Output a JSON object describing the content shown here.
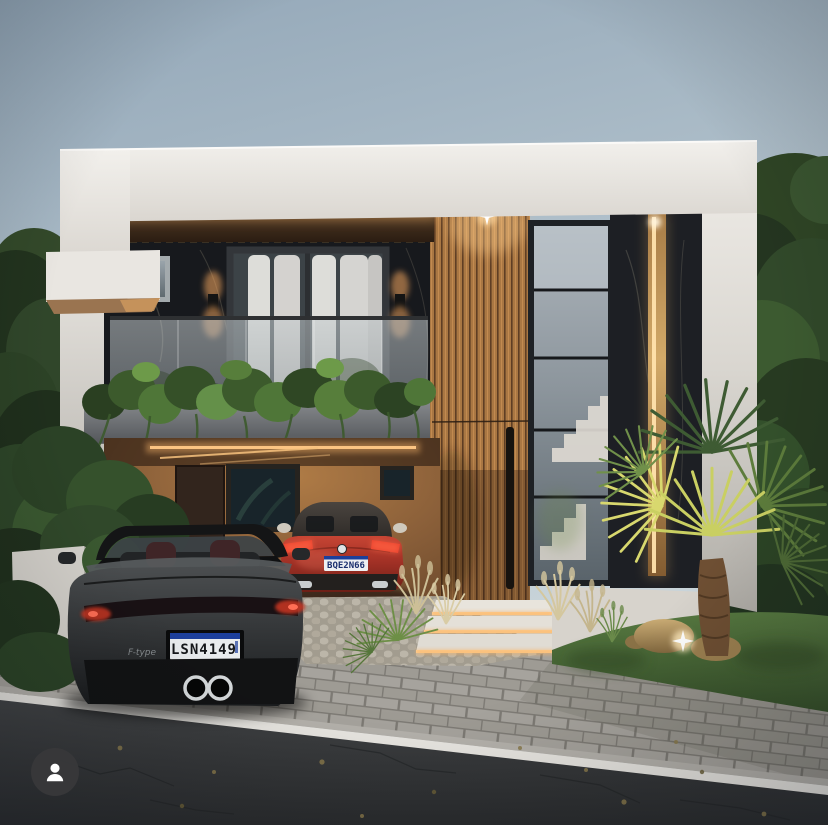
{
  "scene": {
    "black_car": {
      "plate_text": "LSN4149",
      "badge_text": "F-type"
    },
    "red_car": {
      "plate_text": "BQE2N66"
    }
  },
  "ui": {
    "avatar_icon": "person-icon"
  },
  "palette": {
    "sky_top": "#93a7b8",
    "sky_bottom": "#d0dade",
    "white_wall": "#e9e6e1",
    "marble": "#17191d",
    "wood_slats": "#ad7a46",
    "garage_wall": "#8a5f39",
    "led_warm": "#ffd89e",
    "brass_light": "#ffe2ac",
    "red_car": "#a33126",
    "black_car": "#2a2d2f",
    "road": "#333537",
    "paver": "#a6a39d",
    "grass": "#4e6d37",
    "plate_blue_band": "#1c3f9c"
  }
}
